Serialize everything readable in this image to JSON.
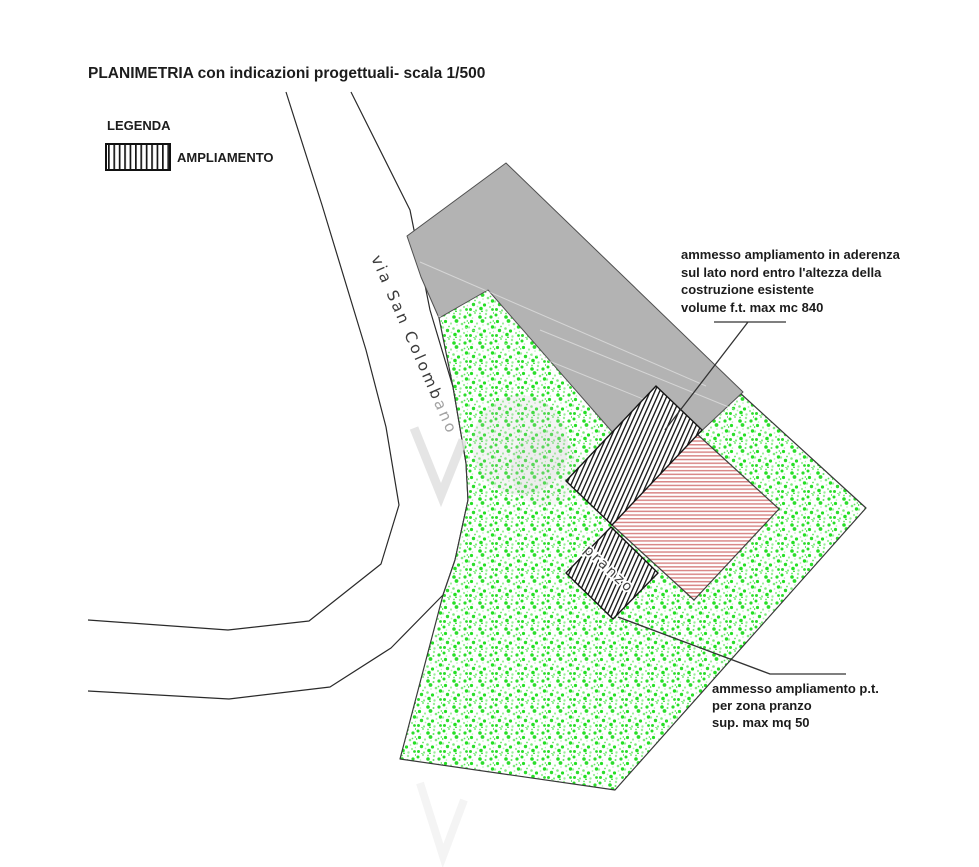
{
  "title": "PLANIMETRIA  con indicazioni progettuali- scala 1/500",
  "legend": {
    "heading": "LEGENDA",
    "items": [
      {
        "label": "AMPLIAMENTO",
        "swatch": "black-vertical-hatch-icon"
      }
    ]
  },
  "road": {
    "name_main": "via San Colomb",
    "name_fade": "ano",
    "full_name": "via San Colombano"
  },
  "site": {
    "pranzo_room_label": "pranzo"
  },
  "annotations": {
    "north_extension": {
      "lines": [
        "ammesso ampliamento in aderenza",
        "sul lato nord entro l'altezza della",
        "costruzione esistente",
        "volume f.t. max mc 840"
      ]
    },
    "south_extension": {
      "lines": [
        "ammesso ampliamento p.t.",
        "per zona pranzo",
        "sup. max mq 50"
      ]
    }
  },
  "colors": {
    "neighbor_building_gray": "#b3b3b3",
    "building_outline": "#4f4f4f",
    "existing_building_hatch_pink": "#d98888",
    "hatch_black": "#161616",
    "lot_speckle_green": "#25e025",
    "line_dark": "#2a2a2a",
    "watermark_gray": "#e0e0e0"
  }
}
